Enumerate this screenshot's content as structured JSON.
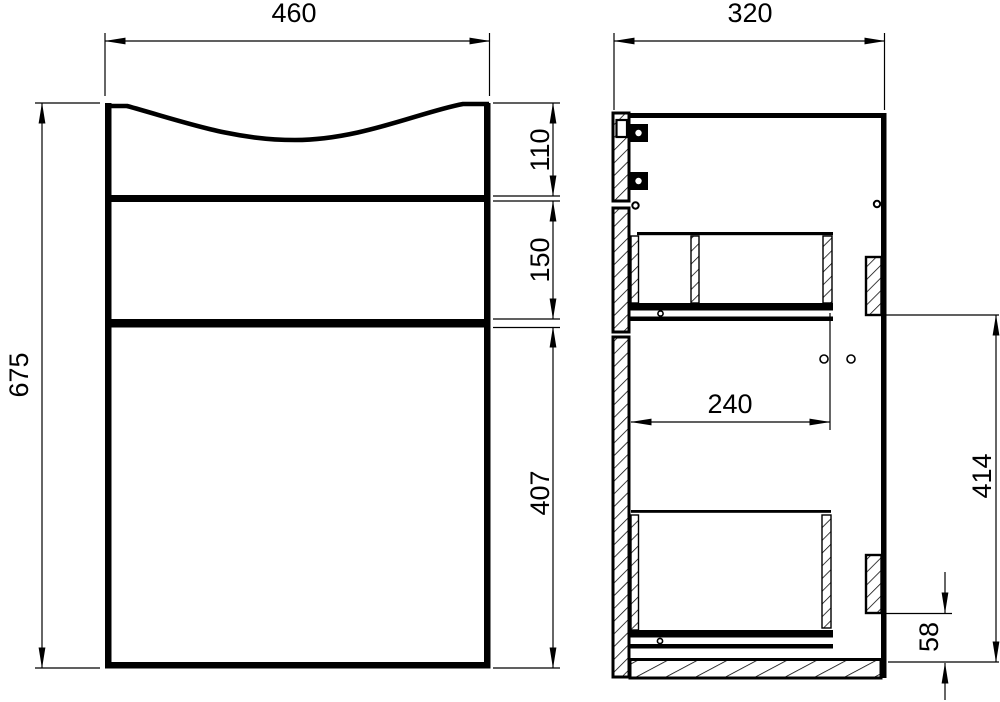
{
  "drawing": {
    "type": "technical-drawing",
    "subject": "vanity cabinet with basin, two views (front and side section)",
    "colors": {
      "line": "#000000",
      "background": "#ffffff"
    },
    "front_view": {
      "dim_width": "460",
      "dim_height": "675",
      "dim_top_section": "110",
      "dim_middle_section": "150",
      "dim_bottom_section": "407"
    },
    "side_view": {
      "dim_depth": "320",
      "dim_drawer_depth": "240",
      "dim_back_span": "414",
      "dim_bottom_offset": "58"
    }
  }
}
